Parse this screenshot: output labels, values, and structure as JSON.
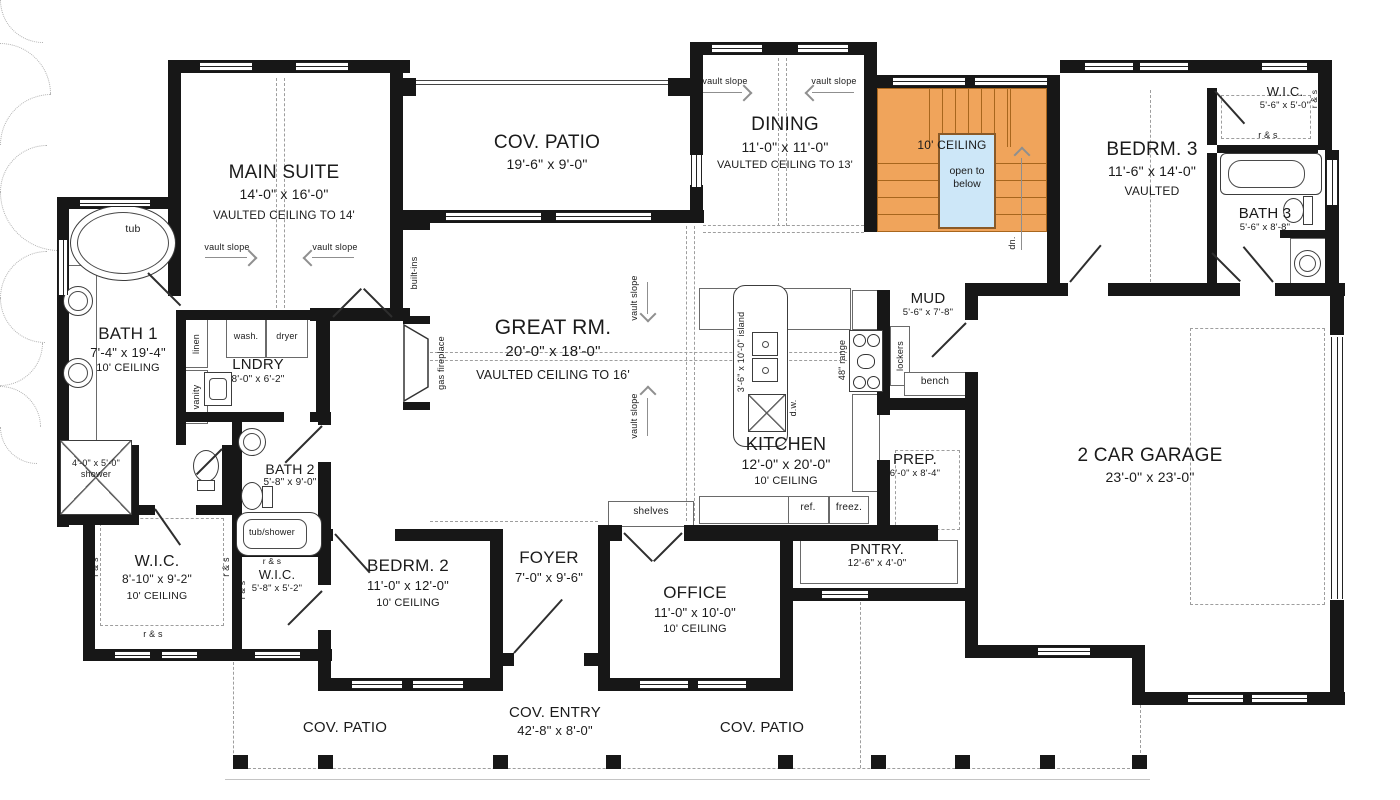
{
  "colors": {
    "wall": "#171717",
    "stair_fill": "#f0a45b",
    "stair_line": "#a8661d",
    "open_below_fill": "#cde7f8",
    "dash": "#9e9e9e"
  },
  "labels": {
    "vault_slope": "vault slope",
    "rs": "r & s",
    "main_suite": {
      "name": "MAIN SUITE",
      "dims": "14'-0\" x 16'-0\"",
      "note": "VAULTED CEILING TO 14'"
    },
    "cov_patio_top": {
      "name": "COV. PATIO",
      "dims": "19'-6\" x 9'-0\""
    },
    "dining": {
      "name": "DINING",
      "dims": "11'-0\" x 11'-0\"",
      "note": "VAULTED CEILING TO 13'"
    },
    "stairs": {
      "ceiling": "10' CEILING",
      "open_below": "open to below",
      "dn": "dn."
    },
    "bedrm3": {
      "name": "BEDRM. 3",
      "dims": "11'-6\" x 14'-0\"",
      "note": "VAULTED"
    },
    "wic3": {
      "name": "W.I.C.",
      "dims": "5'-6\" x 5'-0\""
    },
    "bath3": {
      "name": "BATH 3",
      "dims": "5'-6\" x 8'-8\""
    },
    "great_rm": {
      "name": "GREAT RM.",
      "dims": "20'-0\" x 18'-0\"",
      "note": "VAULTED CEILING TO 16'"
    },
    "kitchen": {
      "name": "KITCHEN",
      "dims": "12'-0\" x 20'-0\"",
      "note": "10' CEILING"
    },
    "island": "3'-6\" x 10'-0\" island",
    "dw": "d.w.",
    "range": "48\" range",
    "ref": "ref.",
    "freez": "freez.",
    "mud": {
      "name": "MUD",
      "dims": "5'-6\" x 7'-8\""
    },
    "lockers": "lockers",
    "bench": "bench",
    "prep": {
      "name": "PREP.",
      "dims": "6'-0\" x 8'-4\""
    },
    "pntry": {
      "name": "PNTRY.",
      "dims": "12'-6\" x 4'-0\""
    },
    "garage": {
      "name": "2 CAR GARAGE",
      "dims": "23'-0\" x 23'-0\""
    },
    "bath1": {
      "name": "BATH 1",
      "dims": "7'-4\" x 19'-4\"",
      "note": "10' CEILING"
    },
    "tub": "tub",
    "linen": "linen",
    "vanity": "vanity",
    "shower": {
      "dims": "4'-0\" x 5'-0\"",
      "name": "shower"
    },
    "lndry": {
      "name": "LNDRY",
      "dims": "8'-0\" x 6'-2\""
    },
    "wash": "wash.",
    "dryer": "dryer",
    "bath2": {
      "name": "BATH 2",
      "dims": "5'-8\" x 9'-0\""
    },
    "tub_shower": "tub/shower",
    "wic1": {
      "name": "W.I.C.",
      "dims": "8'-10\" x 9'-2\"",
      "note": "10' CEILING"
    },
    "wic2": {
      "name": "W.I.C.",
      "dims": "5'-8\" x 5'-2\""
    },
    "bedrm2": {
      "name": "BEDRM. 2",
      "dims": "11'-0\" x 12'-0\"",
      "note": "10' CEILING"
    },
    "foyer": {
      "name": "FOYER",
      "dims": "7'-0\" x 9'-6\""
    },
    "office": {
      "name": "OFFICE",
      "dims": "11'-0\" x 10'-0\"",
      "note": "10' CEILING"
    },
    "shelves": "shelves",
    "built_ins": "built-ins",
    "gas_fireplace": "gas fireplace",
    "cov_entry": {
      "name": "COV. ENTRY",
      "dims": "42'-8\" x 8'-0\""
    },
    "cov_patio_bl": "COV. PATIO",
    "cov_patio_br": "COV. PATIO"
  }
}
